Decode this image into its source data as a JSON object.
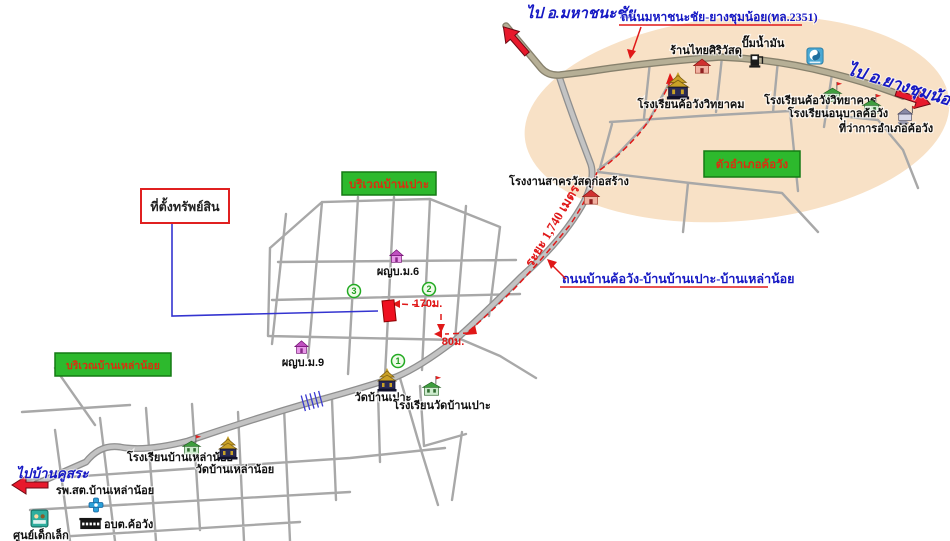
{
  "colors": {
    "ellipse": "#f8e1c6",
    "road_fill": "#bdbdbd",
    "road_casing": "#8f8f8f",
    "highway_fill": "#b6af96",
    "label_blue": "#1518c4",
    "route_red": "#e01818",
    "area_green": "#2db92d",
    "property_red": "#ee1020"
  },
  "directions": {
    "mahachanachai": "ไป อ.มหาชนะชัย",
    "yangchumnoi": "ไป อ.ยางชุมน้อย",
    "bankhusa": "ไปบ้านคูสระ"
  },
  "roads": {
    "highway": "ถนนมหาชนะชัย-ยางชุมน้อย(ทล.2351)",
    "local": "ถนนบ้านค้อวัง-บ้านบ้านเปาะ-บ้านเหล่าน้อย",
    "route_distance": "ระยะ 1,740 เมตร",
    "d170": "170ม.",
    "d80": "80ม."
  },
  "areas": {
    "khowang_town": "ตัวอำเภอค้อวัง",
    "banpo": "บริเวณบ้านเปาะ",
    "banlaonoi": "บริเวณบ้านเหล่าน้อย"
  },
  "property": {
    "label": "ที่ตั้งทรัพย์สิน"
  },
  "places": {
    "thaisiri_shop": "ร้านไทยศิริวัสดุ",
    "gas_station": "ปั๊มน้ำมัน",
    "khowang_wittayakhom_school": "โรงเรียนค้อวังวิทยาคม",
    "khowang_wittayakan_school": "โรงเรียนค้อวังวิทยาคาร",
    "anuban_khowang_school": "โรงเรียนอนุบาลค้อวัง",
    "district_office": "ที่ว่าการอำเภอค้อวัง",
    "sakhon_factory": "โรงงานสาครวัสดุก่อสร้าง",
    "headman_m6": "ผญบ.ม.6",
    "headman_m9": "ผญบ.ม.9",
    "wat_banpo": "วัดบ้านเปาะ",
    "wat_banpo_school": "โรงเรียนวัดบ้านเปาะ",
    "banlaonoi_school": "โรงเรียนบ้านเหล่าน้อย",
    "wat_banlaonoi": "วัดบ้านเหล่าน้อย",
    "health_station": "รพ.สต.บ้านเหล่าน้อย",
    "sao_khowang": "อบต.ค้อวัง",
    "childcare_center": "ศูนย์เด็กเล็ก"
  },
  "markers": {
    "m1": "1",
    "m2": "2",
    "m3": "3"
  }
}
